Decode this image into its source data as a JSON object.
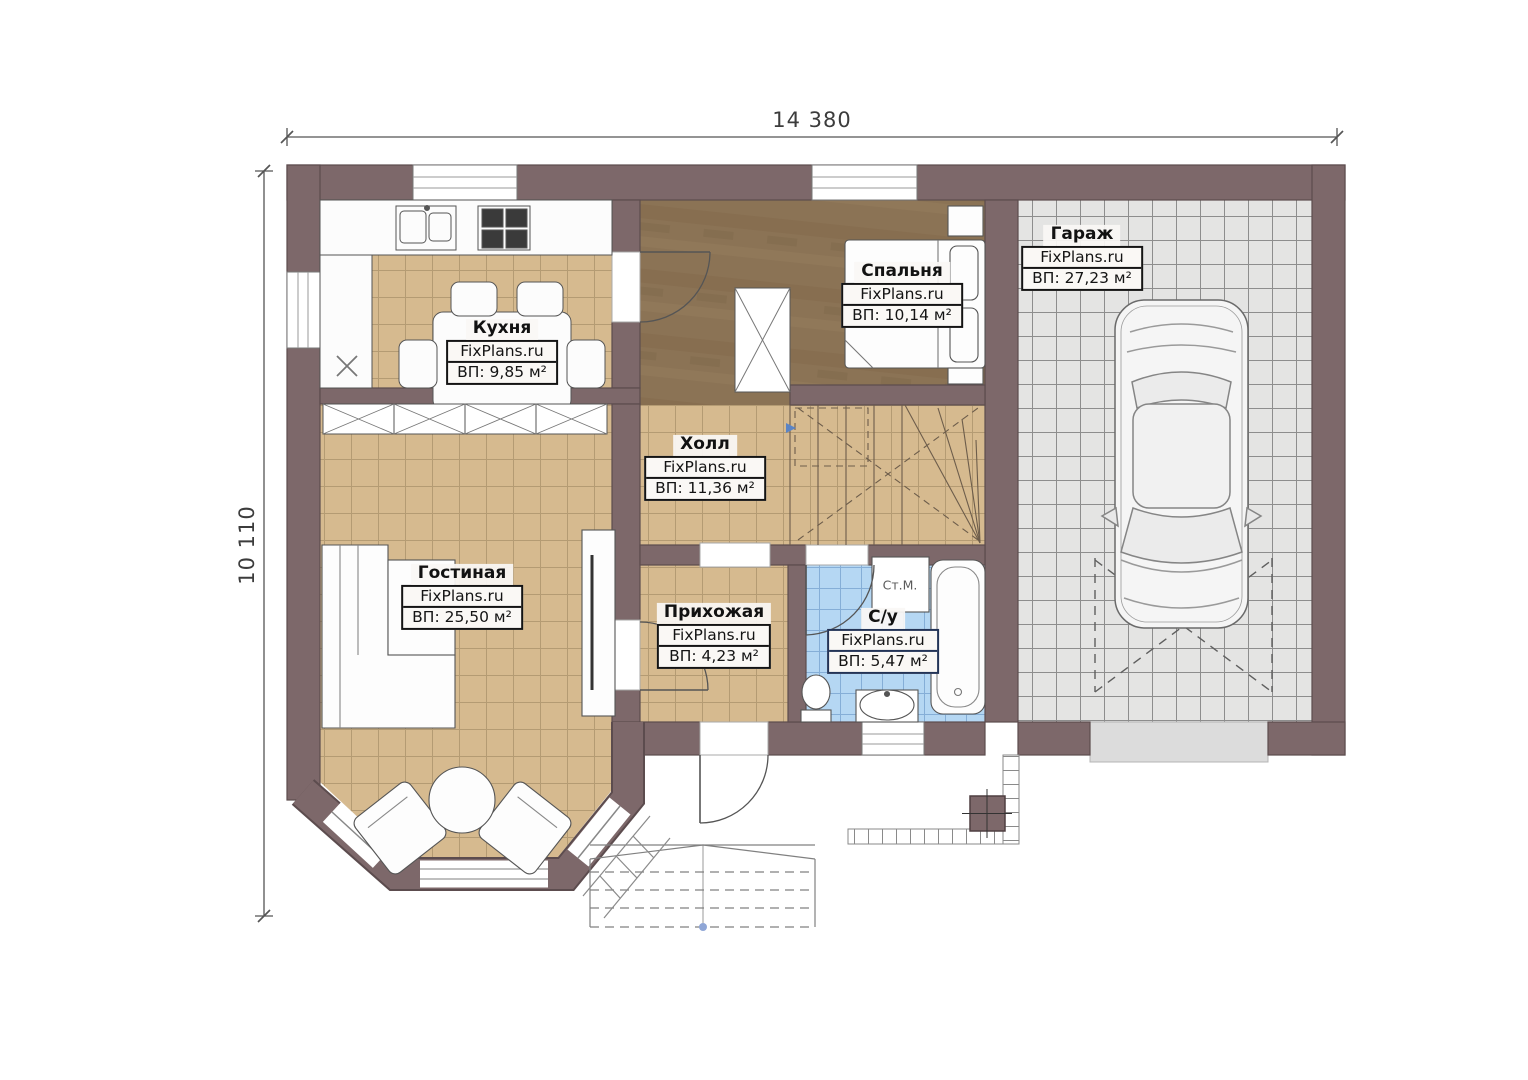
{
  "dimensions": {
    "top": "14 380",
    "left": "10 110"
  },
  "brand": "FixPlans.ru",
  "rooms": {
    "kitchen": {
      "name": "Кухня",
      "area": "ВП: 9,85 м²"
    },
    "bedroom": {
      "name": "Спальня",
      "area": "ВП: 10,14 м²"
    },
    "garage": {
      "name": "Гараж",
      "area": "ВП: 27,23 м²"
    },
    "hall": {
      "name": "Холл",
      "area": "ВП: 11,36 м²"
    },
    "living": {
      "name": "Гостиная",
      "area": "ВП: 25,50 м²"
    },
    "entry": {
      "name": "Прихожая",
      "area": "ВП: 4,23 м²"
    },
    "bathroom": {
      "name": "С/у",
      "area": "ВП: 5,47 м²"
    }
  },
  "labels": {
    "washing_machine": "Ст.М."
  },
  "colors": {
    "wall": "#7d686a",
    "wall_outline": "#5c4c4e",
    "tile_tan": "#d6ba8f",
    "tile_blue": "#b5d7f3",
    "floor_brown": "#8b7355",
    "garage_floor": "#e4e4e3",
    "bath_label_border": "#233457",
    "dimension_line": "#555555"
  }
}
